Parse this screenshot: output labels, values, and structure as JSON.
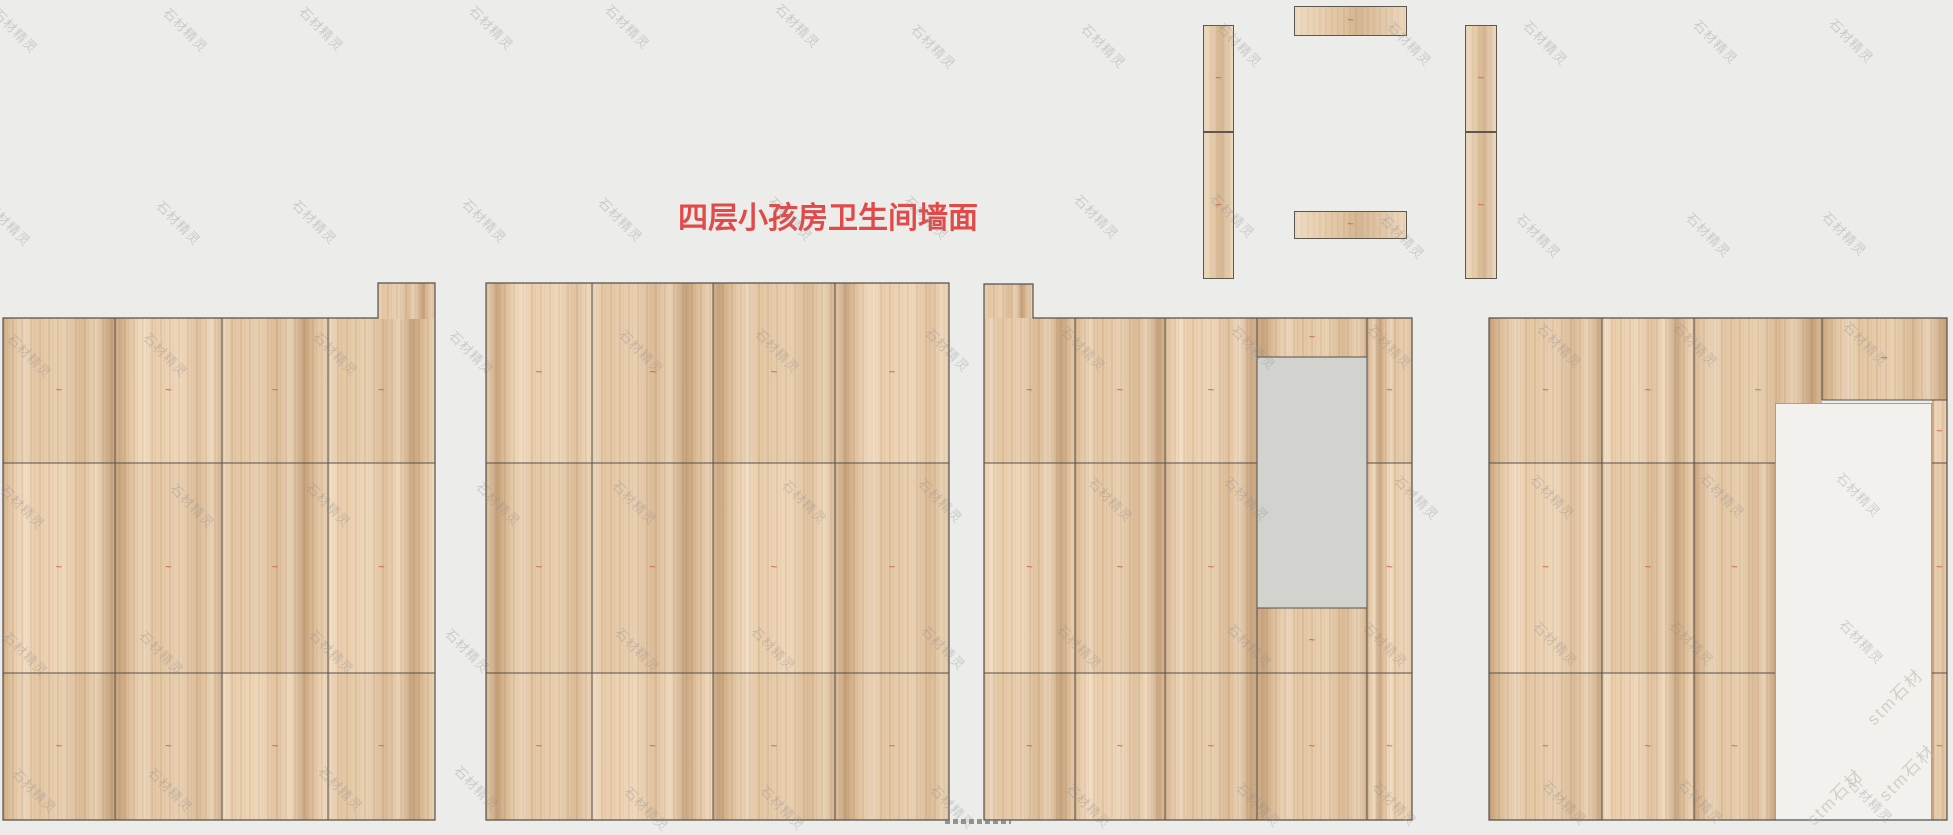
{
  "title": {
    "text": "四层小孩房卫生间墙面"
  },
  "watermark": {
    "primary": "石材精灵",
    "secondary": "stm石材"
  },
  "slab_mark_glyph": "~",
  "colors": {
    "background": "#ececea",
    "title_red": "#e24a4a",
    "wood_base": "#e4c7a3",
    "joint_line": "#55504b",
    "opening_gray": "#d2d2cf",
    "opening_light": "#f2f1ed",
    "watermark_gray": "#8a8a8a",
    "mark_red": "#cf6a4e"
  }
}
